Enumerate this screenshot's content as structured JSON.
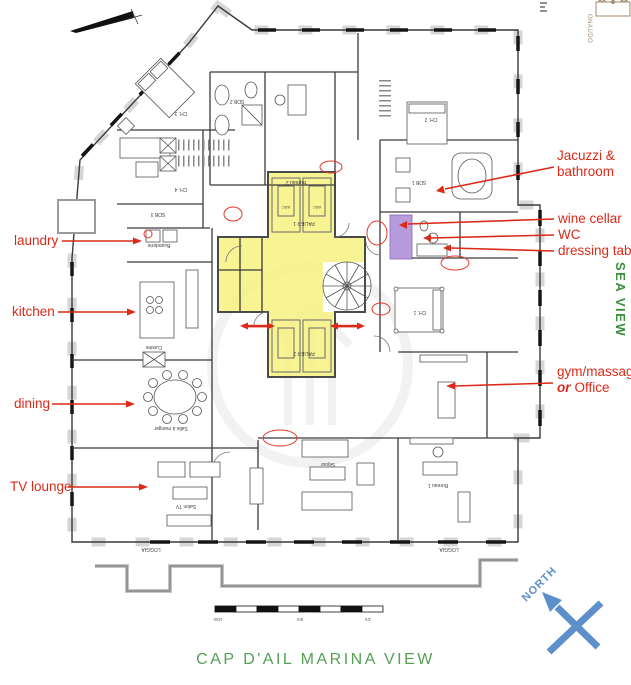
{
  "page_title": "CAP D'AIL MARINA VIEW",
  "sea_view_label": "SEA VIEW",
  "north_label": "NORTH",
  "watermark_text": "ONAUDO",
  "colors": {
    "annotation_red": "#dc2a1a",
    "highlight_yellow": "#f7f180",
    "wine_cellar_purple": "#b79bdc",
    "sea_view_green": "#3e8e3e",
    "title_green": "#55a055",
    "north_blue": "#5d8fca"
  },
  "annotations": {
    "left": [
      {
        "label": "laundry"
      },
      {
        "label": "kitchen"
      },
      {
        "label": "dining"
      },
      {
        "label": "TV lounge"
      }
    ],
    "right": [
      {
        "line1": "Jacuzzi &",
        "line2": "bathroom"
      },
      {
        "label": "wine cellar"
      },
      {
        "label": "WC"
      },
      {
        "label": "dressing table"
      },
      {
        "line1": "gym/massage",
        "or_word": "or",
        "line2": "Office"
      }
    ]
  },
  "scale_bar": {
    "left": "10m",
    "mid": "5m",
    "right": "1m"
  },
  "rooms": {
    "ch1": "CH. 1",
    "ch2": "CH. 2",
    "ch3": "CH. 3",
    "ch4": "CH. 4",
    "sdb1": "SDB 1",
    "sdb2": "SDB 2",
    "sdb3": "SDB 3",
    "bureau1": "Bureau 1",
    "bureau2": "Bureau 2",
    "sejour": "Séjour",
    "salon_tv": "Salon TV",
    "cuisine": "Cuisine",
    "buanderie": "Buanderie",
    "salle_a_manger": "Salle à manger",
    "palier1": "PALIER 1",
    "palier2": "PALIER 2",
    "asc": "ASC",
    "loggia": "LOGGIA"
  }
}
